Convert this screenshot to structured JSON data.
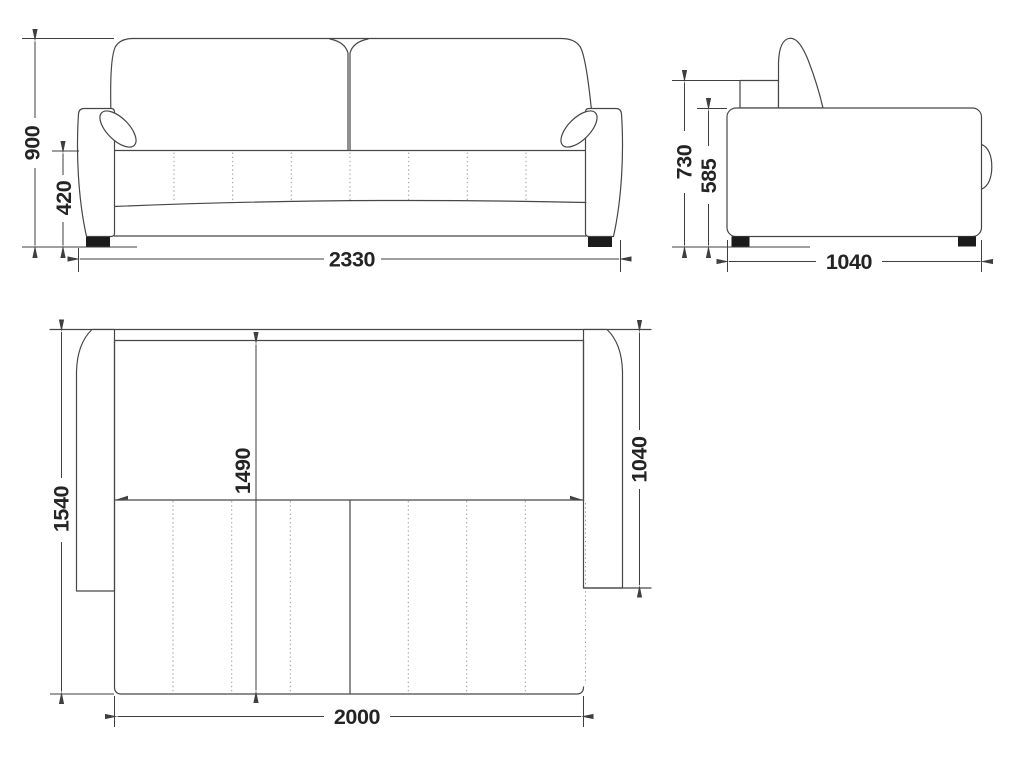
{
  "drawing": {
    "type": "sofa-bed three-view technical drawing",
    "colors": {
      "ink": "#474747",
      "dimension_ink": "#3f3f3f",
      "text_ink": "#242424",
      "hidden_line": "#9b9b9b",
      "foot_fill": "#1b1b1b",
      "background": "#ffffff"
    },
    "dimensions": {
      "front": {
        "overall_height": "900",
        "seat_height": "420",
        "overall_width": "2330"
      },
      "side": {
        "overall_height": "730",
        "armrest_height": "585",
        "overall_depth": "1040"
      },
      "top": {
        "unfolded_depth": "1540",
        "bed_length": "1490",
        "armrest_length": "1040",
        "bed_width": "2000"
      }
    }
  }
}
